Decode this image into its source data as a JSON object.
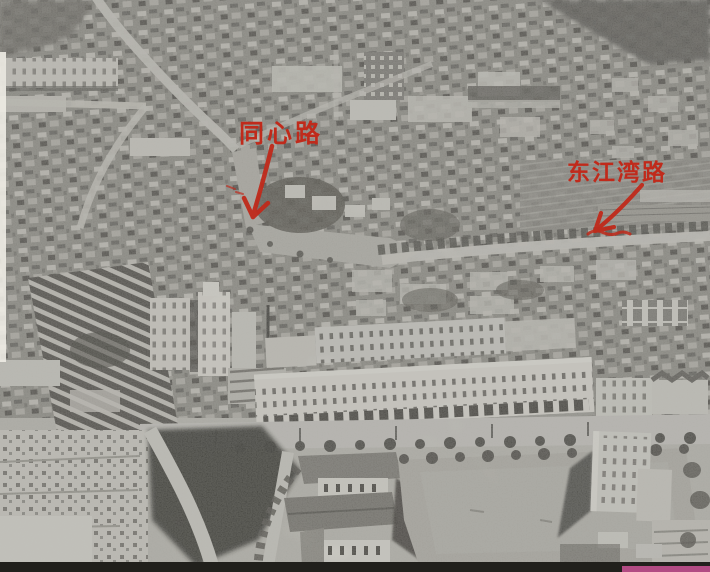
{
  "photo": {
    "alt": "Black-and-white historical aerial photograph of a dense city district: low-rise housing above, a long multi-storey apartment block in the centre, a large open sports field at the lower right, marked with two red hand-drawn road annotations",
    "annotation_color": "#c02a1b",
    "annotations": [
      {
        "id": "tongxin-road",
        "text": "同心路"
      },
      {
        "id": "dongjiangwan-road",
        "text": "东江湾路"
      }
    ],
    "artifacts": {
      "magenta_strip_color": "#c2508f",
      "bottom_strip_color": "#21201c",
      "left_edge_strip_color": "#eeece4"
    }
  }
}
